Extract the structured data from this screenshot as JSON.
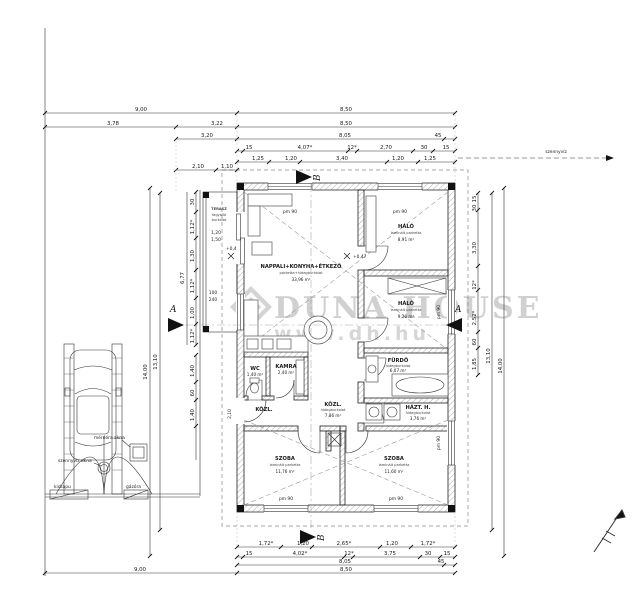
{
  "watermark": {
    "name": "DUNA HOUSE",
    "reg": "®",
    "url": "www.dh.hu"
  },
  "rooms": {
    "terasz": {
      "name": "TERASZ",
      "note1": "fagyálló",
      "note2": "burkolat"
    },
    "nappali": {
      "name": "NAPPALI+KONYHA+ÉTKEZŐ",
      "note": "parketta+hidegburkolat",
      "area": "33,96 m²"
    },
    "halo1": {
      "name": "HÁLÓ",
      "note": "laminált parketta",
      "area": "8,91 m²"
    },
    "halo2": {
      "name": "HÁLÓ",
      "note": "laminált parketta",
      "area": "9,20 m²"
    },
    "furdo": {
      "name": "FÜRDŐ",
      "note": "hidegburkolat",
      "area": "6,07 m²"
    },
    "haztartasi": {
      "name": "HÁZT. H.",
      "note": "hidegburkolat",
      "area": "3,76 m²"
    },
    "szoba_bal": {
      "name": "SZOBA",
      "note": "laminált parketta",
      "area": "11,76 m²"
    },
    "szoba_jobb": {
      "name": "SZOBA",
      "note": "laminált parketta",
      "area": "11,60 m²"
    },
    "kozl": {
      "name": "KÖZL.",
      "note": "hidegburkolat",
      "area": "7,86 m²"
    },
    "kozl2": {
      "name": "KÖZL."
    },
    "wc": {
      "name": "WC",
      "area": "1,40 m²"
    },
    "kamra": {
      "name": "KAMRA",
      "area": "2,40 m²"
    }
  },
  "levels": {
    "terrace": "+0,45",
    "interior": "+0,47"
  },
  "tags": {
    "pm90": "pm 90",
    "k100": "100",
    "k240": "240",
    "t120": "1,20",
    "t150": "1,50",
    "d210": "2,10"
  },
  "site": {
    "kiskapu": "kiskapu",
    "gazora": "gázóra",
    "meroora": "mérőóra akna",
    "szennyviz_akna": "szennyvíz akna",
    "szennyviz": "szennyvíz"
  },
  "markers": {
    "a": "A",
    "b": "B"
  },
  "dims": {
    "top1": [
      "9,00",
      "8,50"
    ],
    "top2": [
      "3,78",
      "3,22",
      "8,50"
    ],
    "top3": [
      "3,20",
      "8,05",
      "45"
    ],
    "top4": [
      "15",
      "4,07*",
      "12*",
      "2,70",
      "30",
      "15"
    ],
    "top5": [
      "1,25",
      "1,20",
      "3,40",
      "1,20",
      "1,25"
    ],
    "top6": [
      "2,10",
      "1,10"
    ],
    "bottom1": [
      "1,72*",
      "1,20",
      "2,65*",
      "1,20",
      "1,72*"
    ],
    "bottom2": [
      "15",
      "4,02*",
      "12*",
      "3,75",
      "30",
      "15"
    ],
    "bottom3": [
      "8,05",
      "45"
    ],
    "bottom4": [
      "8,50"
    ],
    "bottom5": [
      "9,00"
    ],
    "left1": [
      "30",
      "1,12*",
      "1,30",
      "1,12*",
      "1,00",
      "1,12*"
    ],
    "left2": [
      "1,40",
      "60",
      "1,40"
    ],
    "left3": "14,00",
    "left4": "13,10",
    "left5": "6,77",
    "right1": [
      "15",
      "30",
      "3,30",
      "12*",
      "2,52*",
      "60",
      "1,85"
    ],
    "right2": "13,10",
    "right3": "14,00"
  }
}
